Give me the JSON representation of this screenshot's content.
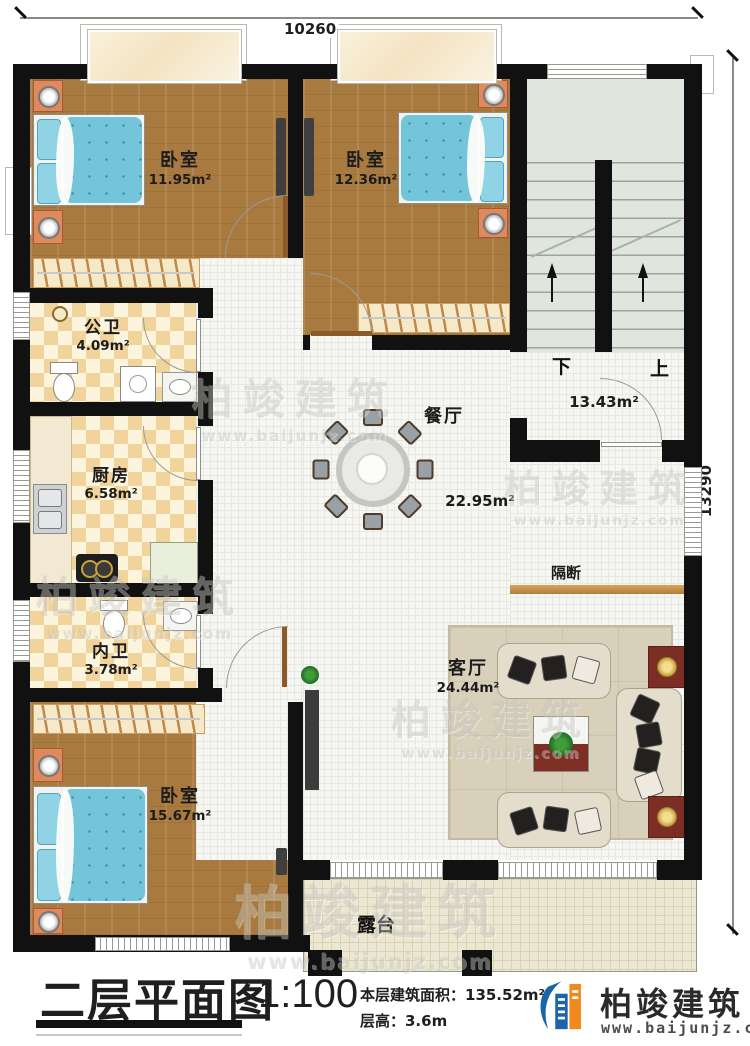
{
  "dimensions": {
    "top": "10260",
    "right": "13290"
  },
  "rooms": [
    {
      "id": "bedroom1",
      "name": "卧室",
      "area": "11.95m²"
    },
    {
      "id": "bedroom2",
      "name": "卧室",
      "area": "12.36m²"
    },
    {
      "id": "stair-hall",
      "name": "",
      "area": "13.43m²"
    },
    {
      "id": "public-bath",
      "name": "公卫",
      "area": "4.09m²"
    },
    {
      "id": "kitchen",
      "name": "厨房",
      "area": "6.58m²"
    },
    {
      "id": "dining",
      "name": "餐厅",
      "area": "22.95m²"
    },
    {
      "id": "inner-bath",
      "name": "内卫",
      "area": "3.78m²"
    },
    {
      "id": "bedroom3",
      "name": "卧室",
      "area": "15.67m²"
    },
    {
      "id": "living",
      "name": "客厅",
      "area": "24.44m²"
    },
    {
      "id": "partition",
      "name": "隔断",
      "area": ""
    },
    {
      "id": "terrace",
      "name": "露台",
      "area": ""
    }
  ],
  "stairs": {
    "down": "下",
    "up": "上"
  },
  "title_block": {
    "title": "二层平面图",
    "scale": "1:100",
    "area_line": "本层建筑面积：135.52m²",
    "height_line": "层高：3.6m"
  },
  "brand": {
    "name": "柏竣建筑",
    "url": "www.baijunjz.com"
  },
  "watermark": {
    "name": "柏竣建筑",
    "url": "www.baijunjz.com"
  },
  "colors": {
    "wall": "#111111",
    "wood": "#a87a3f",
    "tile1": "#f0d49b",
    "tile2": "#fdf4de",
    "floor": "#f6f6f3",
    "stair": "#e0e6dd",
    "terrace": "#ece7d2",
    "bed": "#74c4da",
    "partition": "#c8914f",
    "bblue": "#1a63ad",
    "borange": "#f08a1d"
  }
}
